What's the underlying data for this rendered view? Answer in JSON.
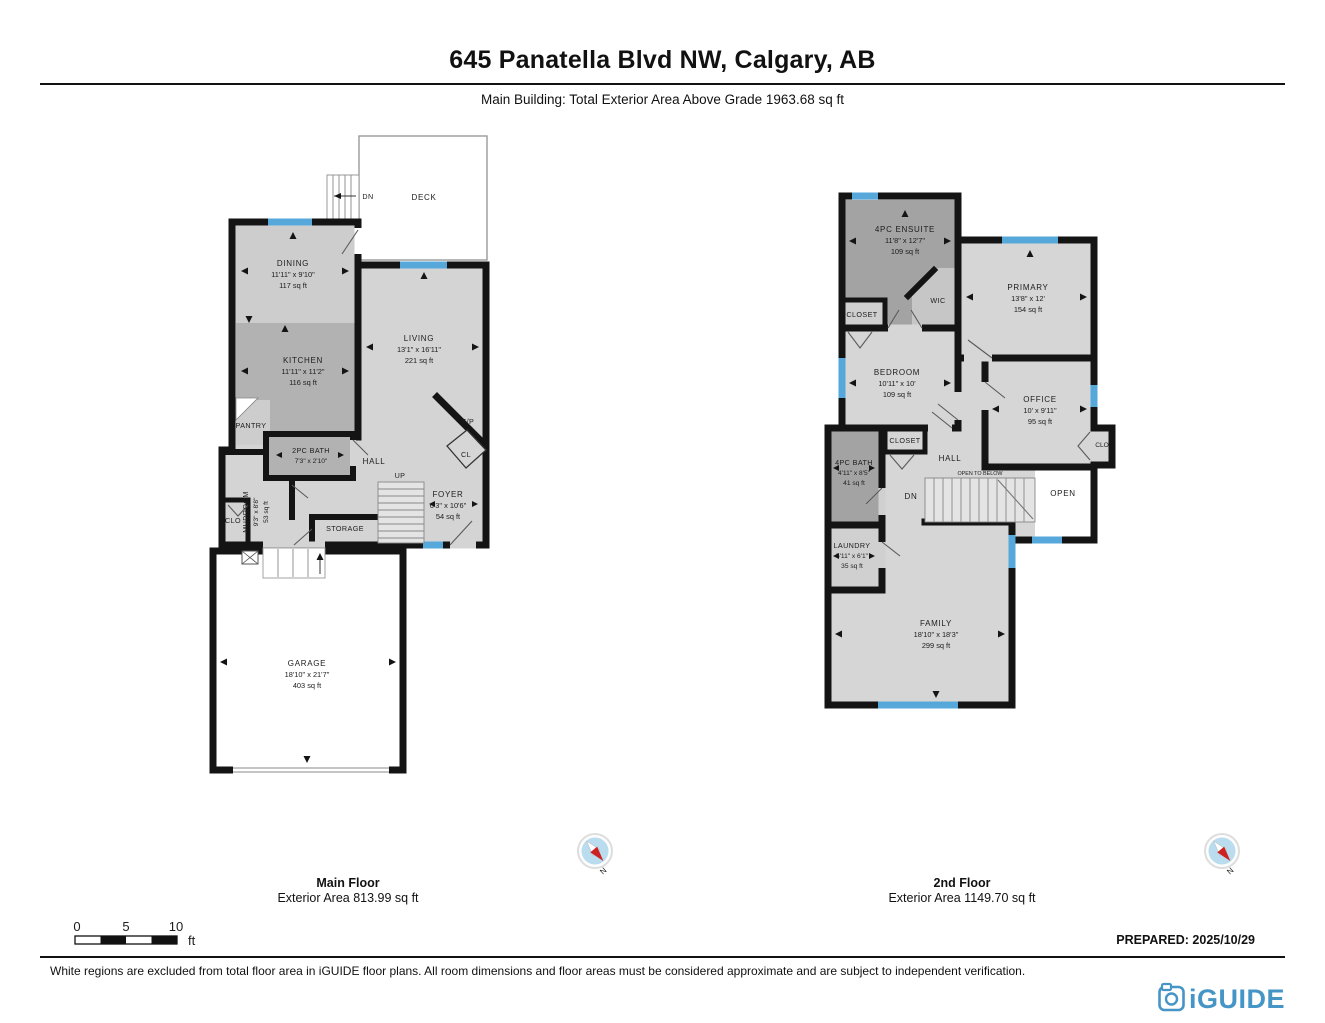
{
  "header": {
    "title": "645 Panatella Blvd NW, Calgary, AB",
    "subtitle": "Main Building: Total Exterior Area Above Grade 1963.68 sq ft"
  },
  "plans": {
    "main": {
      "floor_label": "Main Floor",
      "floor_area": "Exterior Area 813.99 sq ft",
      "rooms": {
        "dining": {
          "name": "DINING",
          "dims": "11'11\" x 9'10\"",
          "area": "117 sq ft"
        },
        "kitchen": {
          "name": "KITCHEN",
          "dims": "11'11\" x 11'2\"",
          "area": "116 sq ft"
        },
        "living": {
          "name": "LIVING",
          "dims": "13'1\" x 16'11\"",
          "area": "221 sq ft"
        },
        "foyer": {
          "name": "FOYER",
          "dims": "6'3\" x 10'6\"",
          "area": "54 sq ft"
        },
        "mudroom": {
          "name": "MUDROOM",
          "dims": "9'3\" x 8'8\"",
          "area": "53 sq ft"
        },
        "bath": {
          "name": "2PC BATH",
          "dims": "7'3\" x 2'10\""
        },
        "garage": {
          "name": "GARAGE",
          "dims": "18'10\" x 21'7\"",
          "area": "403 sq ft"
        },
        "deck": "DECK",
        "pantry": "PANTRY",
        "hall": "HALL",
        "storage": "STORAGE",
        "clo": "CLO",
        "cl": "CL",
        "fp": "F/P",
        "up": "UP",
        "dn": "DN"
      }
    },
    "second": {
      "floor_label": "2nd Floor",
      "floor_area": "Exterior Area 1149.70 sq ft",
      "rooms": {
        "ensuite": {
          "name": "4PC ENSUITE",
          "dims": "11'8\" x 12'7\"",
          "area": "109 sq ft"
        },
        "primary": {
          "name": "PRIMARY",
          "dims": "13'8\" x 12'",
          "area": "154 sq ft"
        },
        "bedroom": {
          "name": "BEDROOM",
          "dims": "10'11\" x 10'",
          "area": "109 sq ft"
        },
        "office": {
          "name": "OFFICE",
          "dims": "10' x 9'11\"",
          "area": "95 sq ft"
        },
        "bath": {
          "name": "4PC BATH",
          "dims": "4'11\" x 8'5\"",
          "area": "41 sq ft"
        },
        "laundry": {
          "name": "LAUNDRY",
          "dims": "5'11\" x 6'1\"",
          "area": "35 sq ft"
        },
        "family": {
          "name": "FAMILY",
          "dims": "18'10\" x 18'3\"",
          "area": "299 sq ft"
        },
        "wic": "WIC",
        "closet_ensuite": "CLOSET",
        "closet_hall": "CLOSET",
        "clo": "CLO",
        "hall": "HALL",
        "open": "OPEN",
        "open_below": "OPEN TO BELOW",
        "dn": "DN"
      }
    }
  },
  "compass": {
    "north_label": "N"
  },
  "scale_bar": {
    "t0": "0",
    "t5": "5",
    "t10": "10",
    "unit": "ft"
  },
  "footer": {
    "prepared": "PREPARED: 2025/10/29",
    "disclaimer": "White regions are excluded from total floor area in iGUIDE floor plans. All room dimensions and floor areas must be considered approximate and are subject to independent verification.",
    "brand": "iGUIDE"
  },
  "palette": {
    "wall": "#141414",
    "window_blue": "#56a8db",
    "floor_light": "#d4d4d4",
    "floor_mid": "#c6c6c6",
    "floor_dark": "#a3a3a3",
    "brand_blue": "#4596c6",
    "compass_red": "#cc2222",
    "compass_globe": "#b9dcef"
  }
}
